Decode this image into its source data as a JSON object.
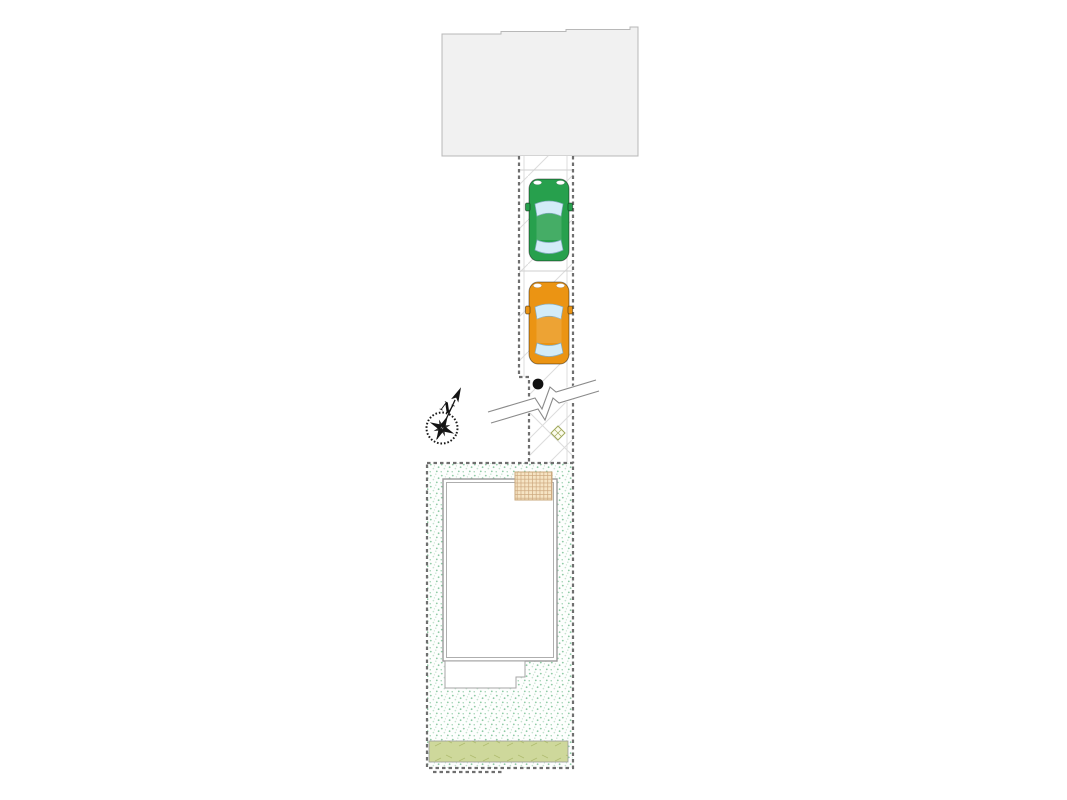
{
  "compass": {
    "north_label": "N"
  },
  "drawing": {
    "adjacent_block": "road-or-neighbor-building",
    "driveway": {
      "surface": "concrete-diagonal-hatch",
      "parking_spaces": 2
    },
    "cars": [
      {
        "name": "sedan-top-view",
        "color": "green"
      },
      {
        "name": "sedan-top-view",
        "color": "orange"
      }
    ],
    "markers": [
      "utility-pole-dot",
      "break-symbol",
      "manhole-diamond"
    ],
    "lot": [
      "stippled-garden",
      "house-footprint",
      "entrance-porch",
      "terrace-step",
      "hedge-strip"
    ]
  },
  "colors": {
    "canvas-bg": "#ffffff",
    "road-fill": "#f1f1f1",
    "road-edge": "#b8b8b8",
    "hatch-line": "#dcdcdc",
    "boundary-line": "#6f6f6f",
    "stipple-dot": "#8fcaa5",
    "stipple-dot2": "#c2e2cd",
    "building-line": "#9a9a9a",
    "porch-fill": "#f6e4c4",
    "porch-edge": "#c9a87c",
    "porch-grid": "#cda87e",
    "hedge-fill": "#ced89b",
    "hedge-mark": "#aebb6f",
    "diamond-edge": "#a0a85a",
    "car-green": "#27a04d",
    "car-orange": "#eb9413",
    "car-window": "#d3ecf8"
  }
}
